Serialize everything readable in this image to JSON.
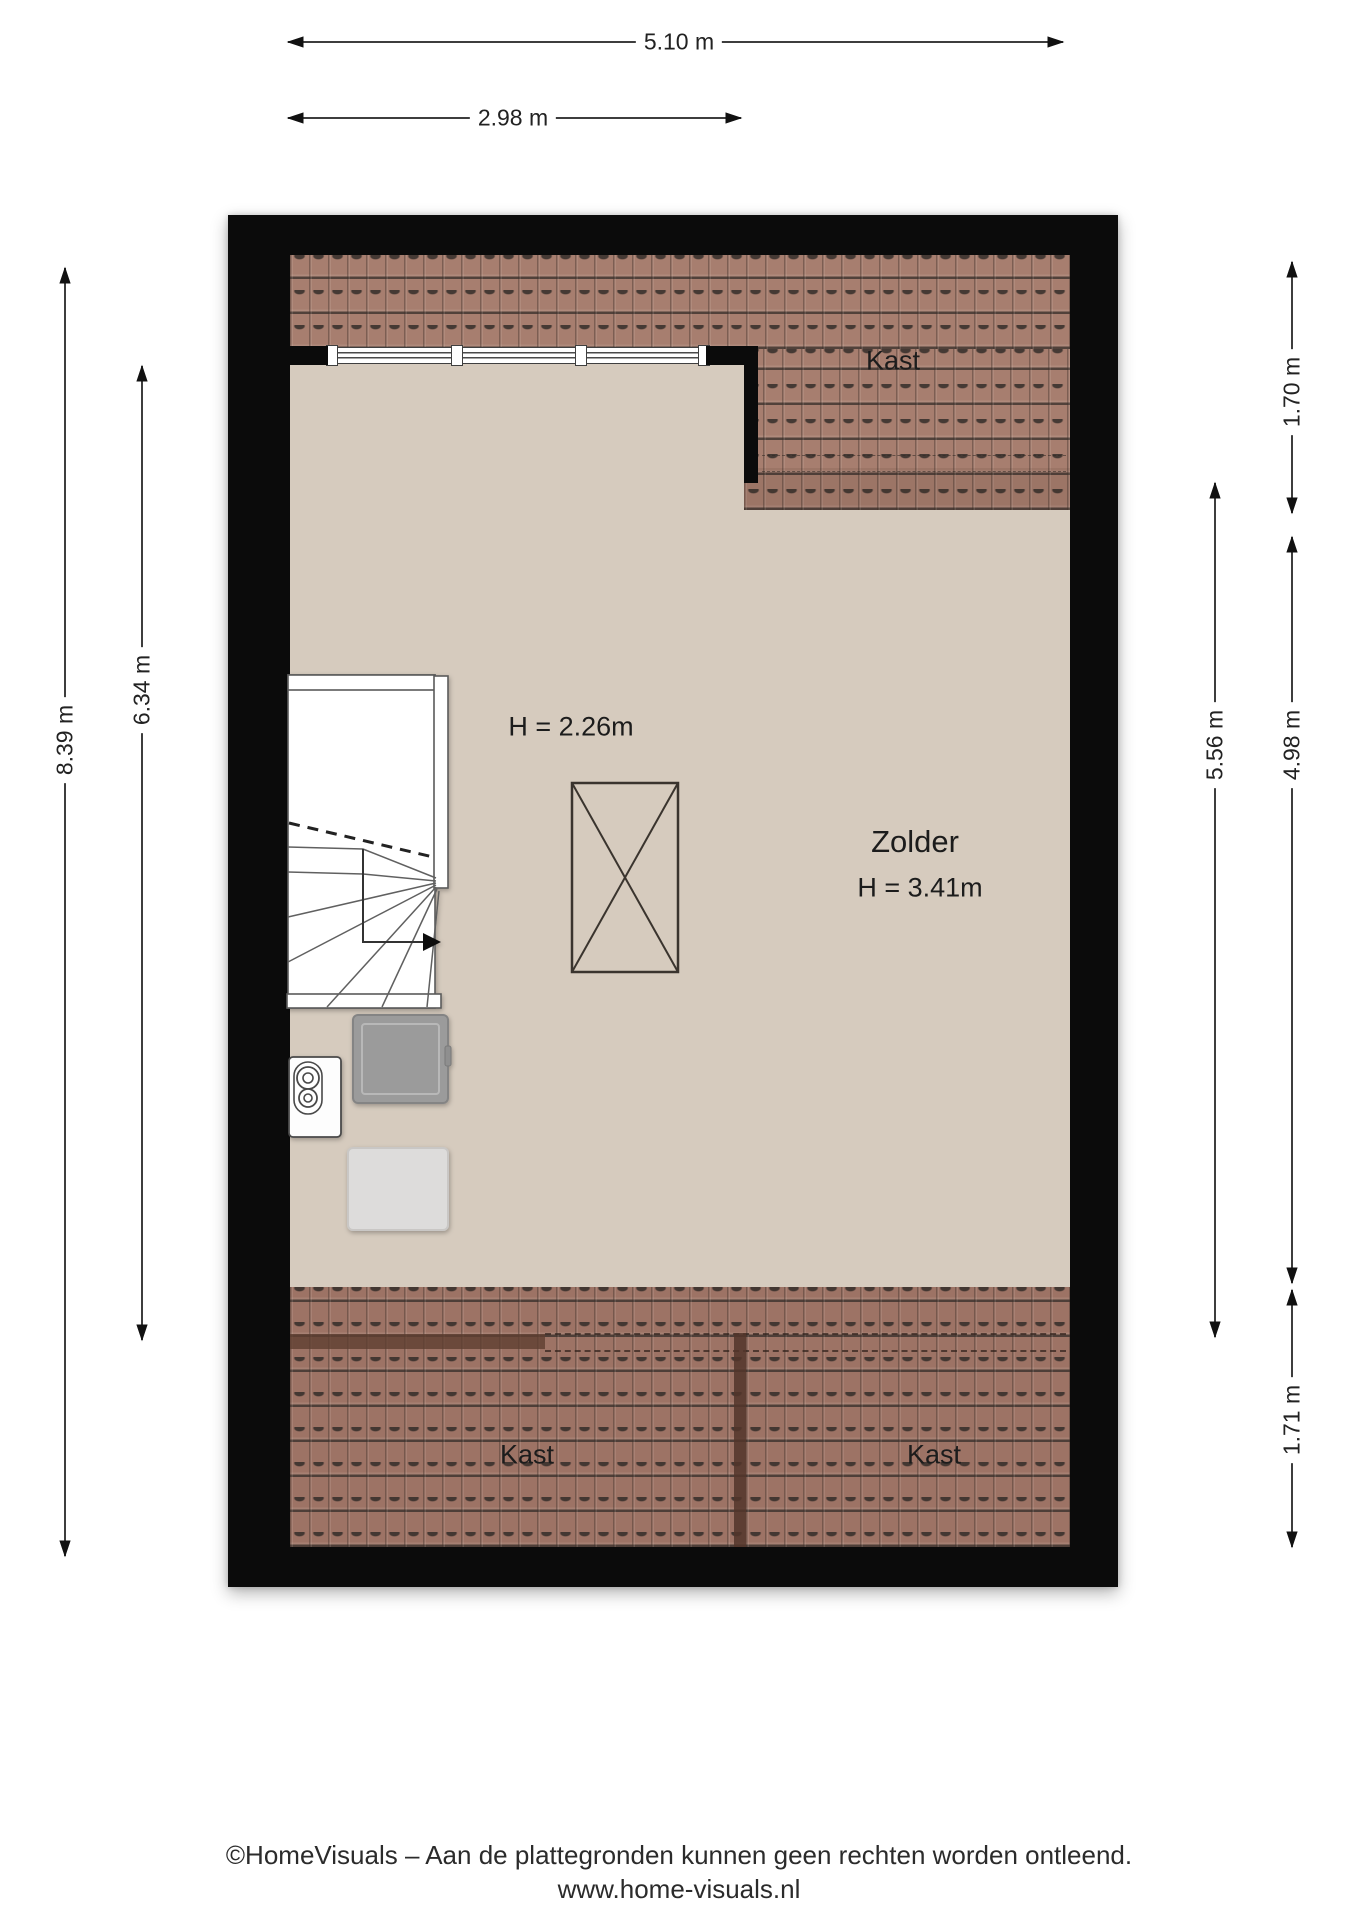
{
  "plan": {
    "dimensions": {
      "width_total": "5.10 m",
      "width_room": "2.98 m",
      "height_total": "8.39 m",
      "height_room": "6.34 m",
      "right_top": "1.70 m",
      "right_inner": "5.56 m",
      "right_mid": "4.98 m",
      "right_bottom": "1.71 m"
    },
    "labels": {
      "kast_top": "Kast",
      "low_ceiling": "H = 2.26m",
      "room_name": "Zolder",
      "room_height": "H = 3.41m",
      "kast_bottom_left": "Kast",
      "kast_bottom_right": "Kast"
    }
  },
  "footer": {
    "disclaimer": "©HomeVisuals – Aan de plattegronden kunnen geen rechten worden ontleend.",
    "website": "www.home-visuals.nl"
  },
  "colors": {
    "wall": "#0b0b0b",
    "floor": "#d6cbbe",
    "tile_base": "#a77e6f",
    "tile_dark": "#9d7365",
    "dim": "#3d3d3d"
  }
}
